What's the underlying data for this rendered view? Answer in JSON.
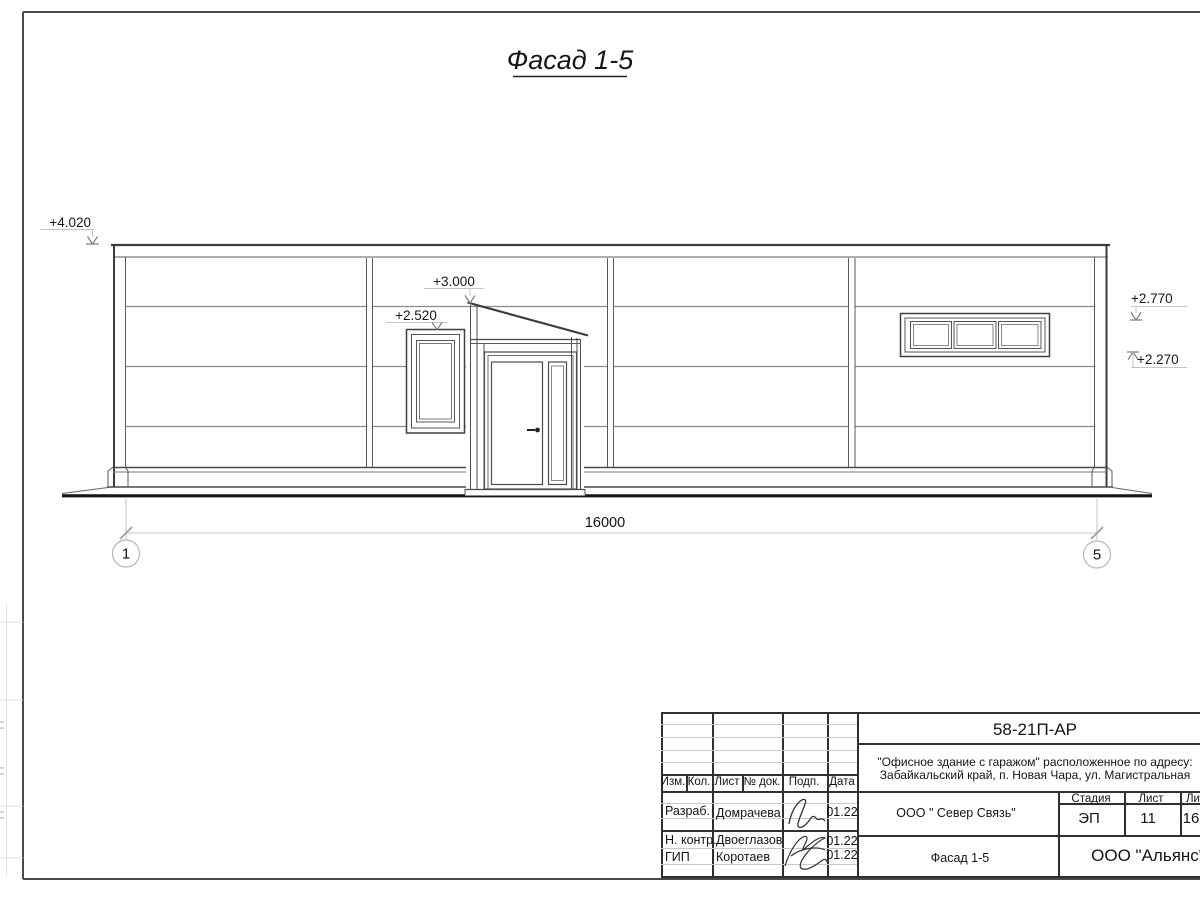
{
  "drawing": {
    "title": "Фасад 1-5",
    "marks": {
      "m4020": "+4.020",
      "m3000": "+3.000",
      "m2520": "+2.520",
      "m2770": "+2.770",
      "m2270": "+2.270"
    },
    "dim_overall": "16000",
    "axis_left": "1",
    "axis_right": "5"
  },
  "title_block": {
    "doc_code": "58-21П-АР",
    "project_line1": "\"Офисное здание с гаражом\" расположенное по адресу:",
    "project_line2": "Забайкальский край, п. Новая Чара, ул. Магистральная",
    "client": "ООО \" Север Связь\"",
    "sheet_name": "Фасад 1-5",
    "company": "ООО \"Альянс\"",
    "headers": {
      "izm": "Изм.",
      "kol": "Кол.",
      "list": "Лист",
      "doc": "№ док.",
      "podp": "Подп.",
      "data": "Дата"
    },
    "stage_header": "Стадия",
    "sheet_header": "Лист",
    "sheets_header": "Листов",
    "stage": "ЭП",
    "sheet_no": "11",
    "sheets_total": "16",
    "roles": [
      {
        "role": "Разраб.",
        "name": "Домрачева",
        "date": "01.22"
      },
      {
        "role": "Н. контр.",
        "name": "Двоеглазов",
        "date": "01.22"
      },
      {
        "role": "ГИП",
        "name": "Коротаев",
        "date": "01.22"
      }
    ]
  }
}
